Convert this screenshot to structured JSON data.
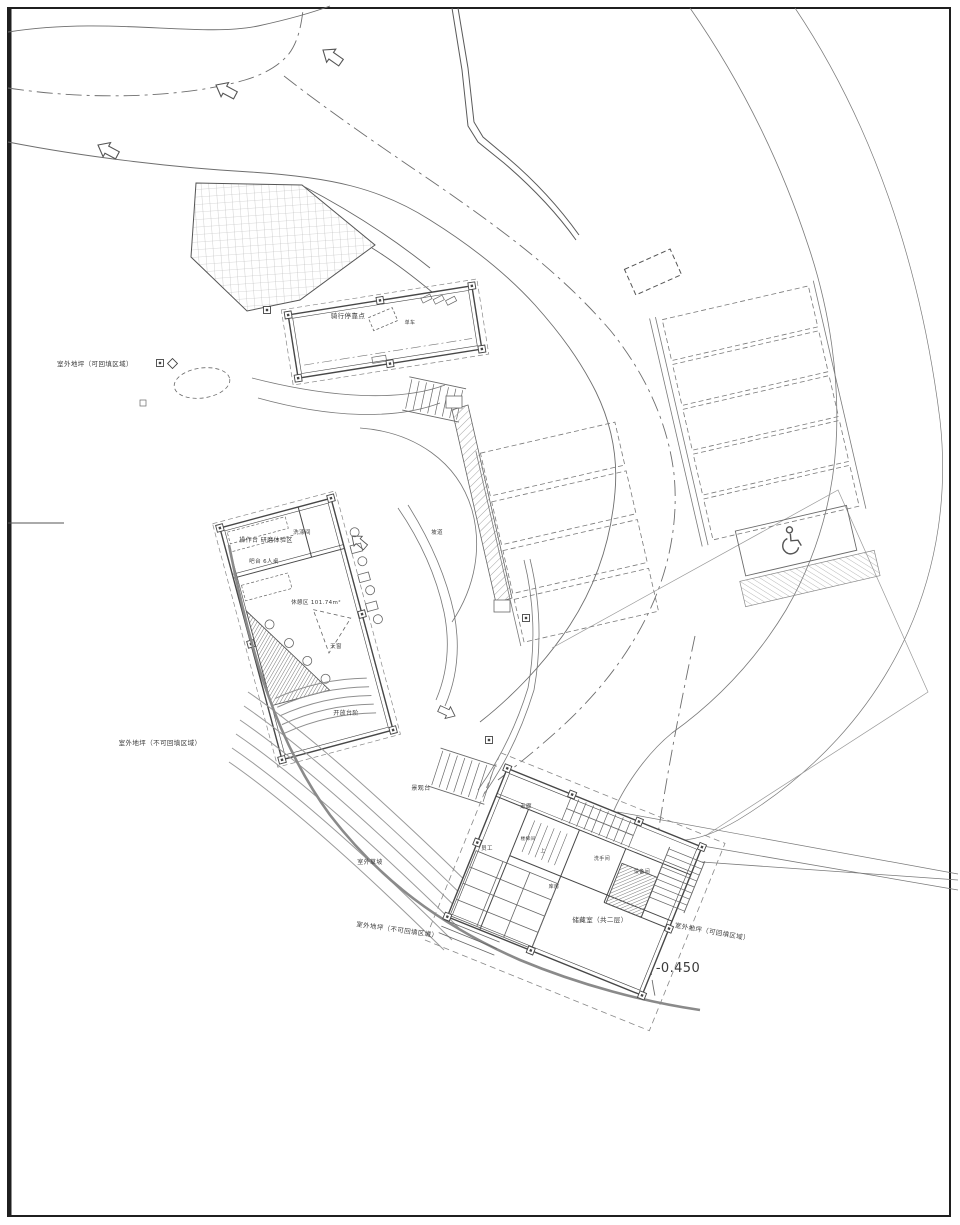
{
  "drawing": {
    "kind": "site-plan",
    "sheet_width_px": 960,
    "sheet_height_px": 1225
  },
  "colors": {
    "background": "#ffffff",
    "line_dark": "#474747",
    "line_mid": "#6e6e6e",
    "line_light": "#9a9a9a",
    "text": "#3a3a3a",
    "level_text": "#8f8f8f"
  },
  "labels": {
    "outdoor_fillable": "室外地坪（可回填区域）",
    "outdoor_nonfillable": "室外地坪（不可回填区域）",
    "bike_stop": "骑行停靠点",
    "bike_note": "单车",
    "operation_area": "操作台 研磨体验区",
    "washing_room": "洗涤间",
    "bar_counter": "吧台 6人桌",
    "rest_area": "休憩区 101.74m²",
    "skylight": "天窗",
    "open_steps": "开放台阶",
    "ramp": "坡道",
    "view_platform": "景观台",
    "lawn_slope": "室外草坡",
    "corridor": "走廊",
    "staff_room": "员工",
    "stair_room": "楼梯间",
    "up_mark": "上",
    "washroom": "洗手间",
    "equipment_room": "设备间",
    "storeroom": "库房",
    "storage_loft": "储藏室（共二层）",
    "level_elevation": "-0.450"
  },
  "icons": {
    "direction_arrow": "block-arrow",
    "accessible_parking": "wheelchair-icon",
    "spot_marker": "square-dot-marker",
    "diamond_marker": "diamond-marker"
  }
}
